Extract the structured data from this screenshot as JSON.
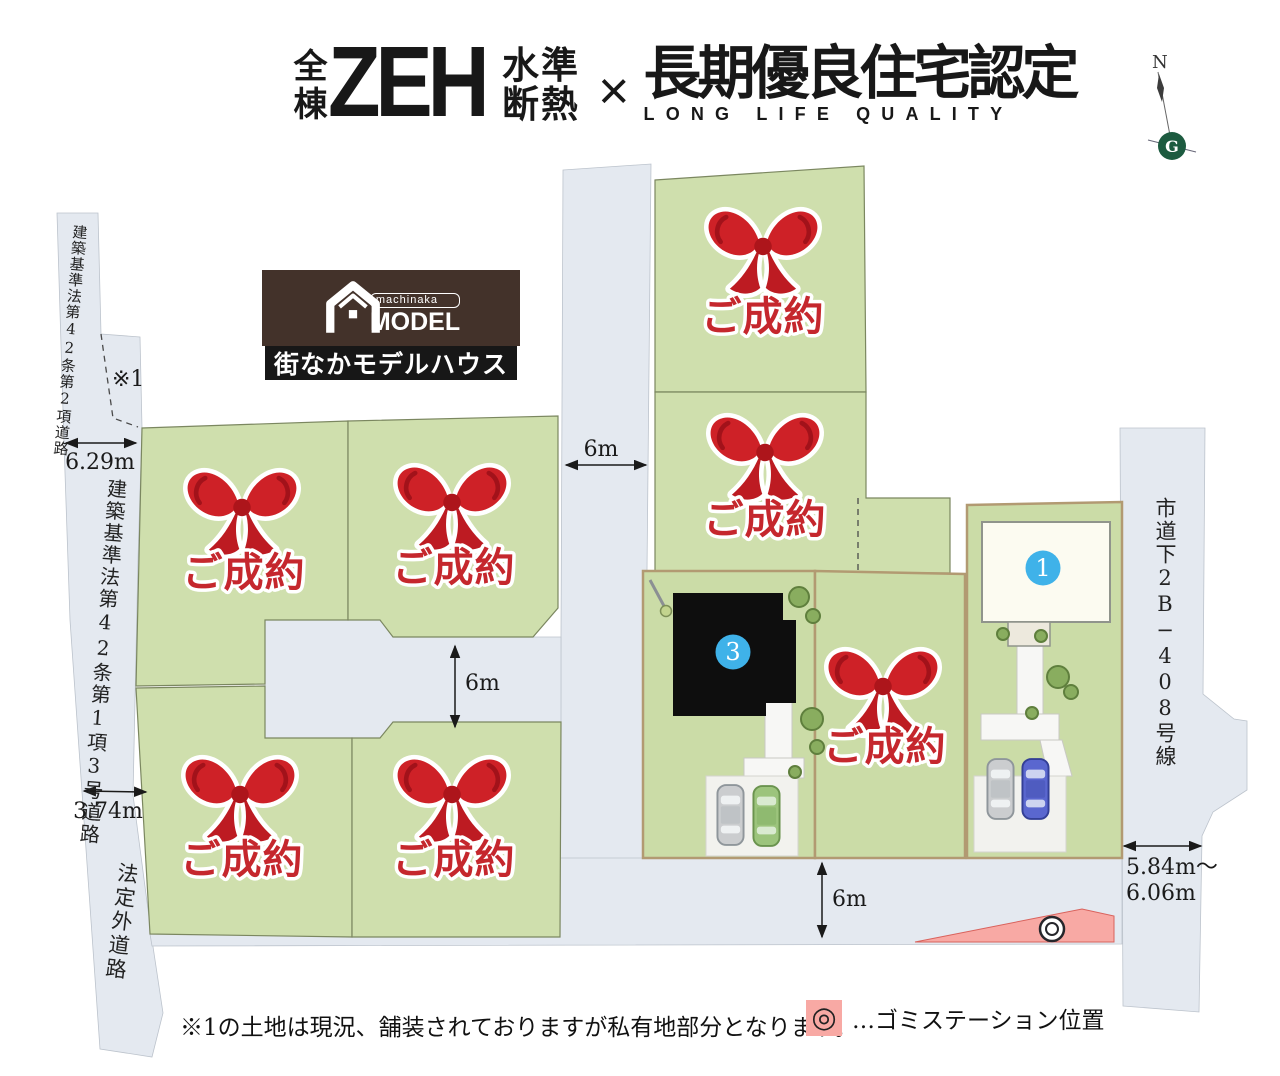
{
  "header": {
    "badge_left": "全棟",
    "zeh": "ZEH",
    "zeh_sub_top": "水準",
    "zeh_sub_bottom": "断熱",
    "separator": "×",
    "title": "長期優良住宅認定",
    "subtitle": "LONG LIFE QUALITY"
  },
  "compass": {
    "north_label": "N",
    "logo_letter": "G"
  },
  "model_house_badge": {
    "brand_small": "machinaka",
    "brand_large": "MODEL",
    "caption": "街なかモデルハウス"
  },
  "roads": {
    "left_top_label": "建築基準法第42条第2項道路",
    "left_middle_label": "建築基準法第42条第1項3号道路",
    "left_bottom_label": "法定外道路",
    "right_label": "市道下2B−408号線"
  },
  "dimensions": {
    "left_top_width": "6.29m",
    "left_middle_width": "3.74m",
    "top_road_width": "6m",
    "middle_road_width": "6m",
    "bottom_road_width": "6m",
    "right_road_width_line1": "5.84m〜",
    "right_road_width_line2": "6.06m"
  },
  "annotations": {
    "note1_marker": "※1"
  },
  "lots": {
    "sold_label": "ご成約",
    "lot1_number": "1",
    "lot3_number": "3"
  },
  "footer": {
    "note": "※1の土地は現況、舗装されておりますが私有地部分となります。",
    "garbage_station_symbol": "◎",
    "garbage_station_label": "…ゴミステーション位置"
  },
  "colors": {
    "lot_green": "#cfdfad",
    "road_gray": "#e4e9f0",
    "ribbon_red": "#ce2127",
    "sold_text_red": "#c5272d",
    "lot_number_blue": "#3fb2e9",
    "station_pink": "#f8a9a4",
    "compass_green": "#1d5b40",
    "badge_brown": "#43322a"
  }
}
